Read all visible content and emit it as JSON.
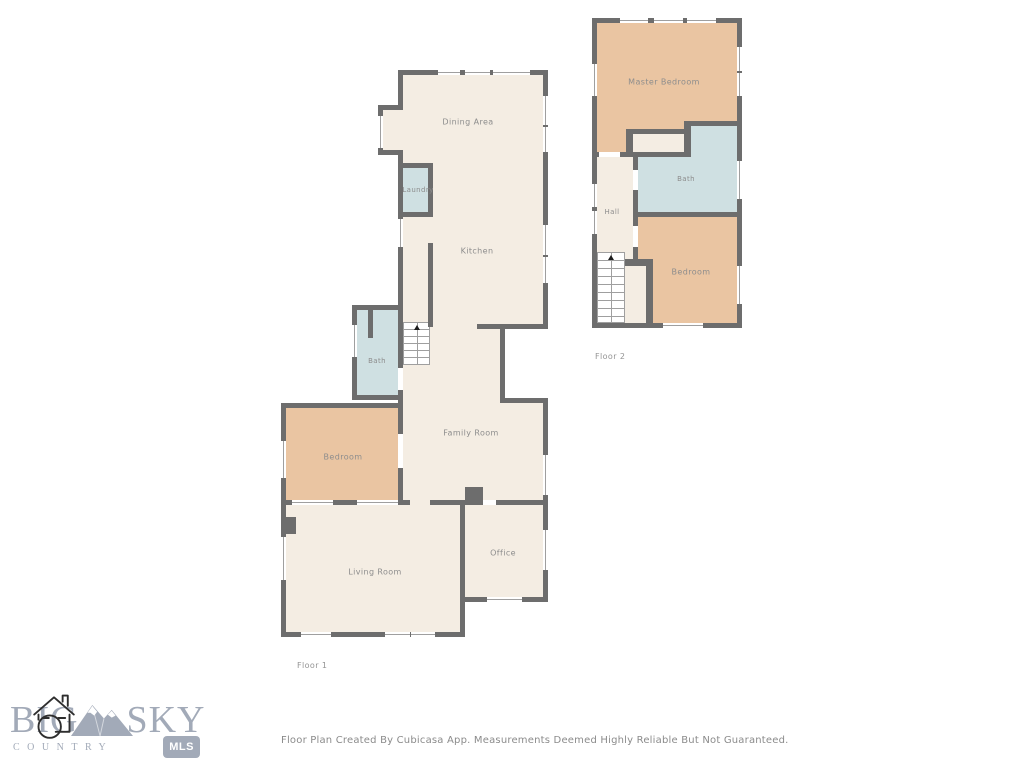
{
  "colors": {
    "wall": "#6d6d6d",
    "room_fill": "#f4ede3",
    "bedroom_fill": "#eac5a2",
    "bath_fill": "#cfe0e2",
    "label_text": "#8d8d8d",
    "logo_gray": "#a2aab8"
  },
  "floor1": {
    "caption": "Floor 1",
    "rooms": {
      "dining_area": "Dining Area",
      "laundry": "Laundry",
      "kitchen": "Kitchen",
      "bath": "Bath",
      "bedroom": "Bedroom",
      "family_room": "Family Room",
      "living_room": "Living Room",
      "office": "Office"
    }
  },
  "floor2": {
    "caption": "Floor 2",
    "rooms": {
      "master_bedroom": "Master Bedroom",
      "bath": "Bath",
      "hall": "Hall",
      "bedroom": "Bedroom"
    }
  },
  "logo": {
    "big": "BIG",
    "sky": "SKY",
    "country": "COUNTRY",
    "mls": "MLS"
  },
  "footer": {
    "disclaimer": "Floor Plan Created By Cubicasa App. Measurements Deemed Highly Reliable But Not Guaranteed."
  }
}
